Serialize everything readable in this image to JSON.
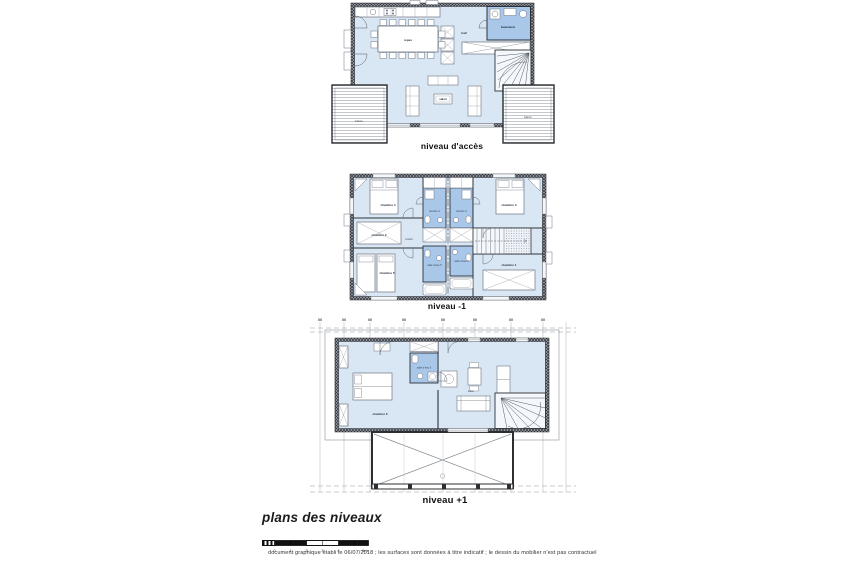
{
  "document": {
    "title": "plans des niveaux",
    "disclaimer": "document graphique établi le 06/07/2018 ; les surfaces sont données à titre indicatif ; le dessin du mobilier n'est pas contractuel"
  },
  "scale_bar": {
    "ticks": [
      "0",
      "1",
      "2",
      "3",
      "4",
      "5m"
    ]
  },
  "levels": [
    {
      "label": "niveau d'accès",
      "rooms": {
        "repas": "repas",
        "salon": "salon",
        "hall": "hall",
        "buanderie": "buanderie",
        "balcon_left": "balcon",
        "balcon_right": "balcon"
      }
    },
    {
      "label": "niveau -1",
      "rooms": {
        "chambre1": "chambre 1",
        "chambre2": "chambre 2",
        "chambre3": "chambre 3",
        "chambre4": "chambre 4",
        "chambre5": "chambre 5",
        "douche3": "douche 3",
        "douche4": "douche 4",
        "salle_eau5": "salle d'eau 5",
        "salle_eau1": "salle d'eau 1",
        "couloir": "couloir"
      }
    },
    {
      "label": "niveau +1",
      "rooms": {
        "chambre6": "chambre 6",
        "salle_eau6": "salle d'eau 6",
        "salon": "salon"
      }
    }
  ],
  "colors": {
    "floor": "#d9e6f4",
    "wet_room": "#a9c7e8",
    "wall_dark": "#2e3238",
    "deck_line": "#9aa0a8",
    "grid": "#c3c8ce",
    "text_dark": "#17202b"
  }
}
